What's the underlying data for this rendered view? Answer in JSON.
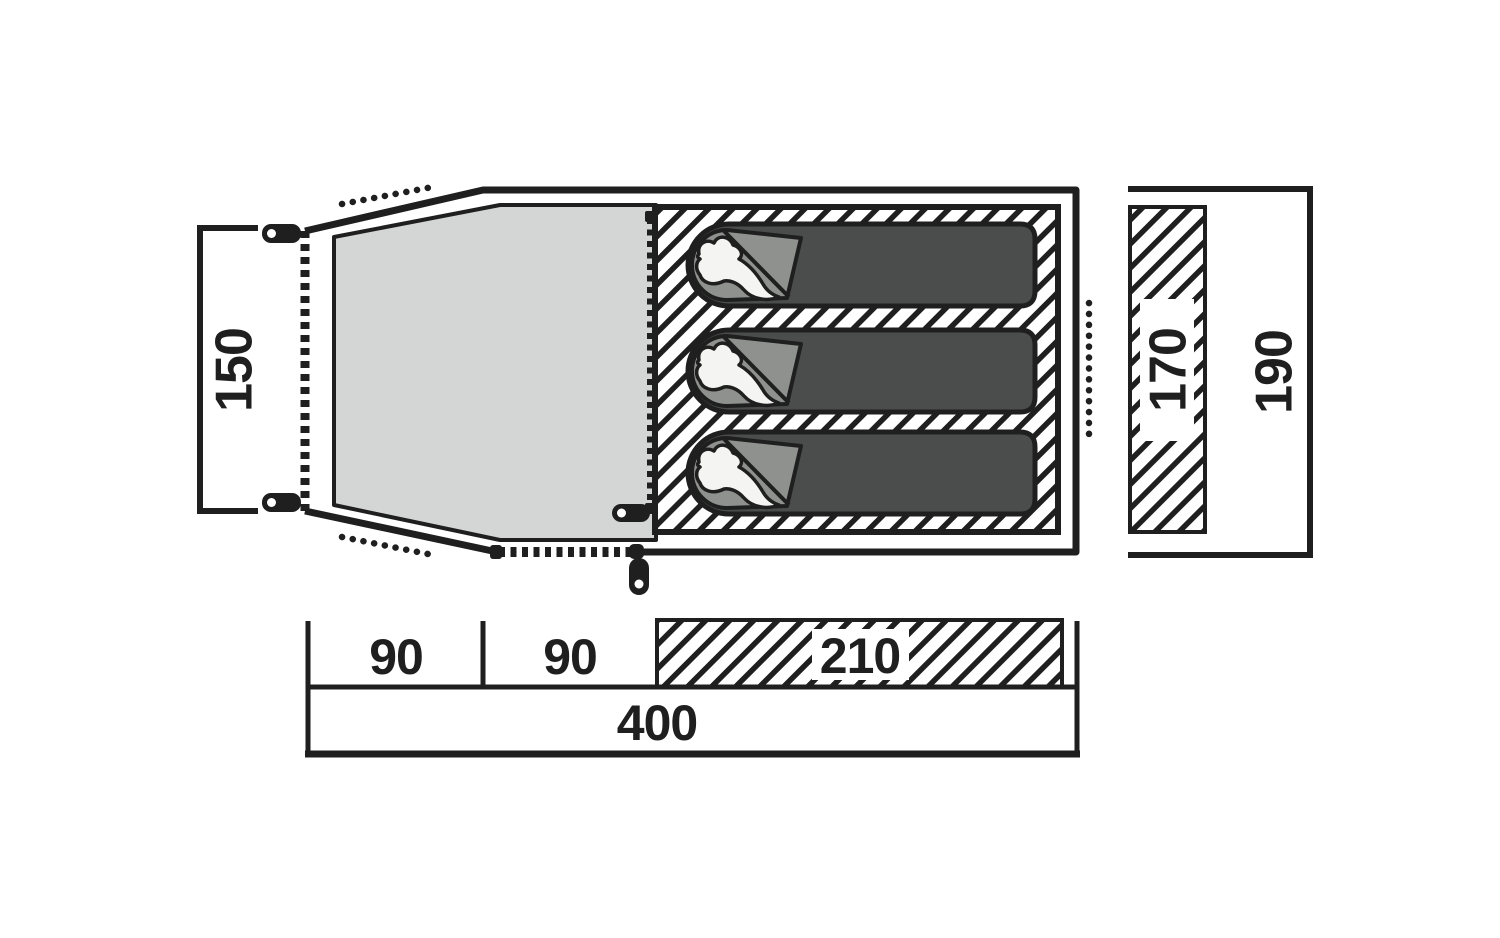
{
  "diagram": {
    "type": "tent-floorplan-top-view",
    "labels": {
      "porch_depth": "150",
      "inner_width": "170",
      "outer_width": "190",
      "porch_section_1": "90",
      "porch_section_2": "90",
      "sleeping_area_length": "210",
      "total_length": "400"
    },
    "sleeping_bag_count": 3,
    "colors": {
      "ink": "#1f1f1f",
      "porch_fill": "#d3d6d4",
      "bag_fill": "#4b4d4c",
      "flap_fill": "#8f918f",
      "pillow_fill": "#f4f4f2",
      "background": "#ffffff"
    }
  }
}
